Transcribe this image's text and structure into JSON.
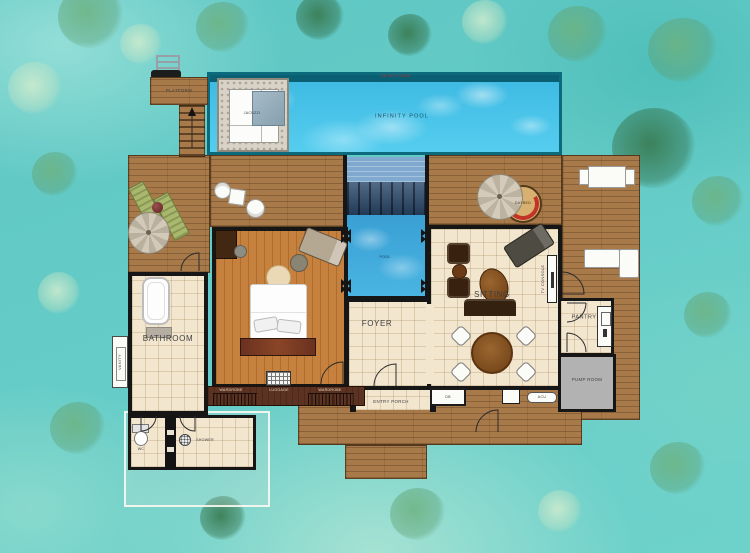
{
  "plan": {
    "outdoor": {
      "platform": "PLATFORM",
      "jacuzzi": "JACUZZI",
      "infinity_pool": "INFINITY POOL",
      "infinity_edge": "INFINITY EDGE",
      "plunge_pool": "POOL",
      "daybed": "DAYBED"
    },
    "rooms": {
      "bathroom": "BATHROOM",
      "vanity": "VANITY",
      "wc": "WC",
      "shower": "SHOWER",
      "sitting": "SITTING",
      "foyer": "FOYER",
      "entry_porch": "ENTRY PORCH",
      "pantry": "PANTRY",
      "pump_room": "PUMP ROOM",
      "wardrobe_left": "WARDROBE",
      "luggage": "LUGGAGE",
      "wardrobe_right": "WARDROBE",
      "tv_console": "TV CONSOLE"
    },
    "equipment": {
      "db": "DB",
      "acu": "ACU"
    },
    "colors": {
      "ocean_water": "#63cbc7",
      "pool_water": "#45c3e8",
      "plunge_pool_water": "#3ba7d9",
      "deck_wood": "#a87a4a",
      "bedroom_wood": "#c5813d",
      "tile_floor": "#f3e6cf",
      "wall": "#161616",
      "pump_room_gray": "#b2b2b2",
      "jacuzzi_stone": "#d9d3c7",
      "lounger_green": "#a9b96c",
      "daybed_cushion_red": "#c23428",
      "pool_edge_text_red": "#c03030"
    }
  }
}
